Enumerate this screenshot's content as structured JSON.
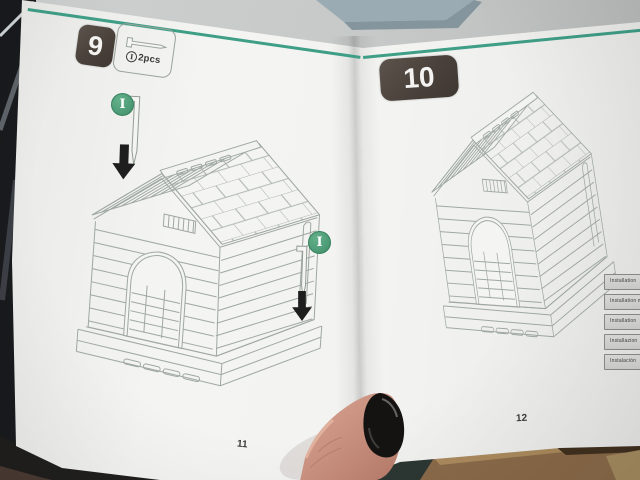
{
  "booklet": {
    "left_page": {
      "step_badge": "9",
      "parts_box": {
        "part_id": "I",
        "qty": "2pcs"
      },
      "markers": [
        {
          "label": "I"
        },
        {
          "label": "I"
        }
      ],
      "page_number": "11"
    },
    "right_page": {
      "step_badge": "10",
      "side_labels": [
        {
          "text": "Installation"
        },
        {
          "text": "Installation m"
        },
        {
          "text": "Installation"
        },
        {
          "text": "Installazion"
        },
        {
          "text": "Instalación"
        }
      ],
      "page_number": "12"
    }
  },
  "icons": {
    "parts_box_icon": "ground-pin-horizontal",
    "step_marker_icon": "ground-pin-vertical",
    "direction_icon": "down-arrow",
    "diagram": "dog-house-line-drawing"
  },
  "colors": {
    "accent_line": "#3f9e86",
    "step_badge_bg": "#49413a",
    "marker_green": "#4f9d78",
    "nail_polish": "#141312"
  }
}
